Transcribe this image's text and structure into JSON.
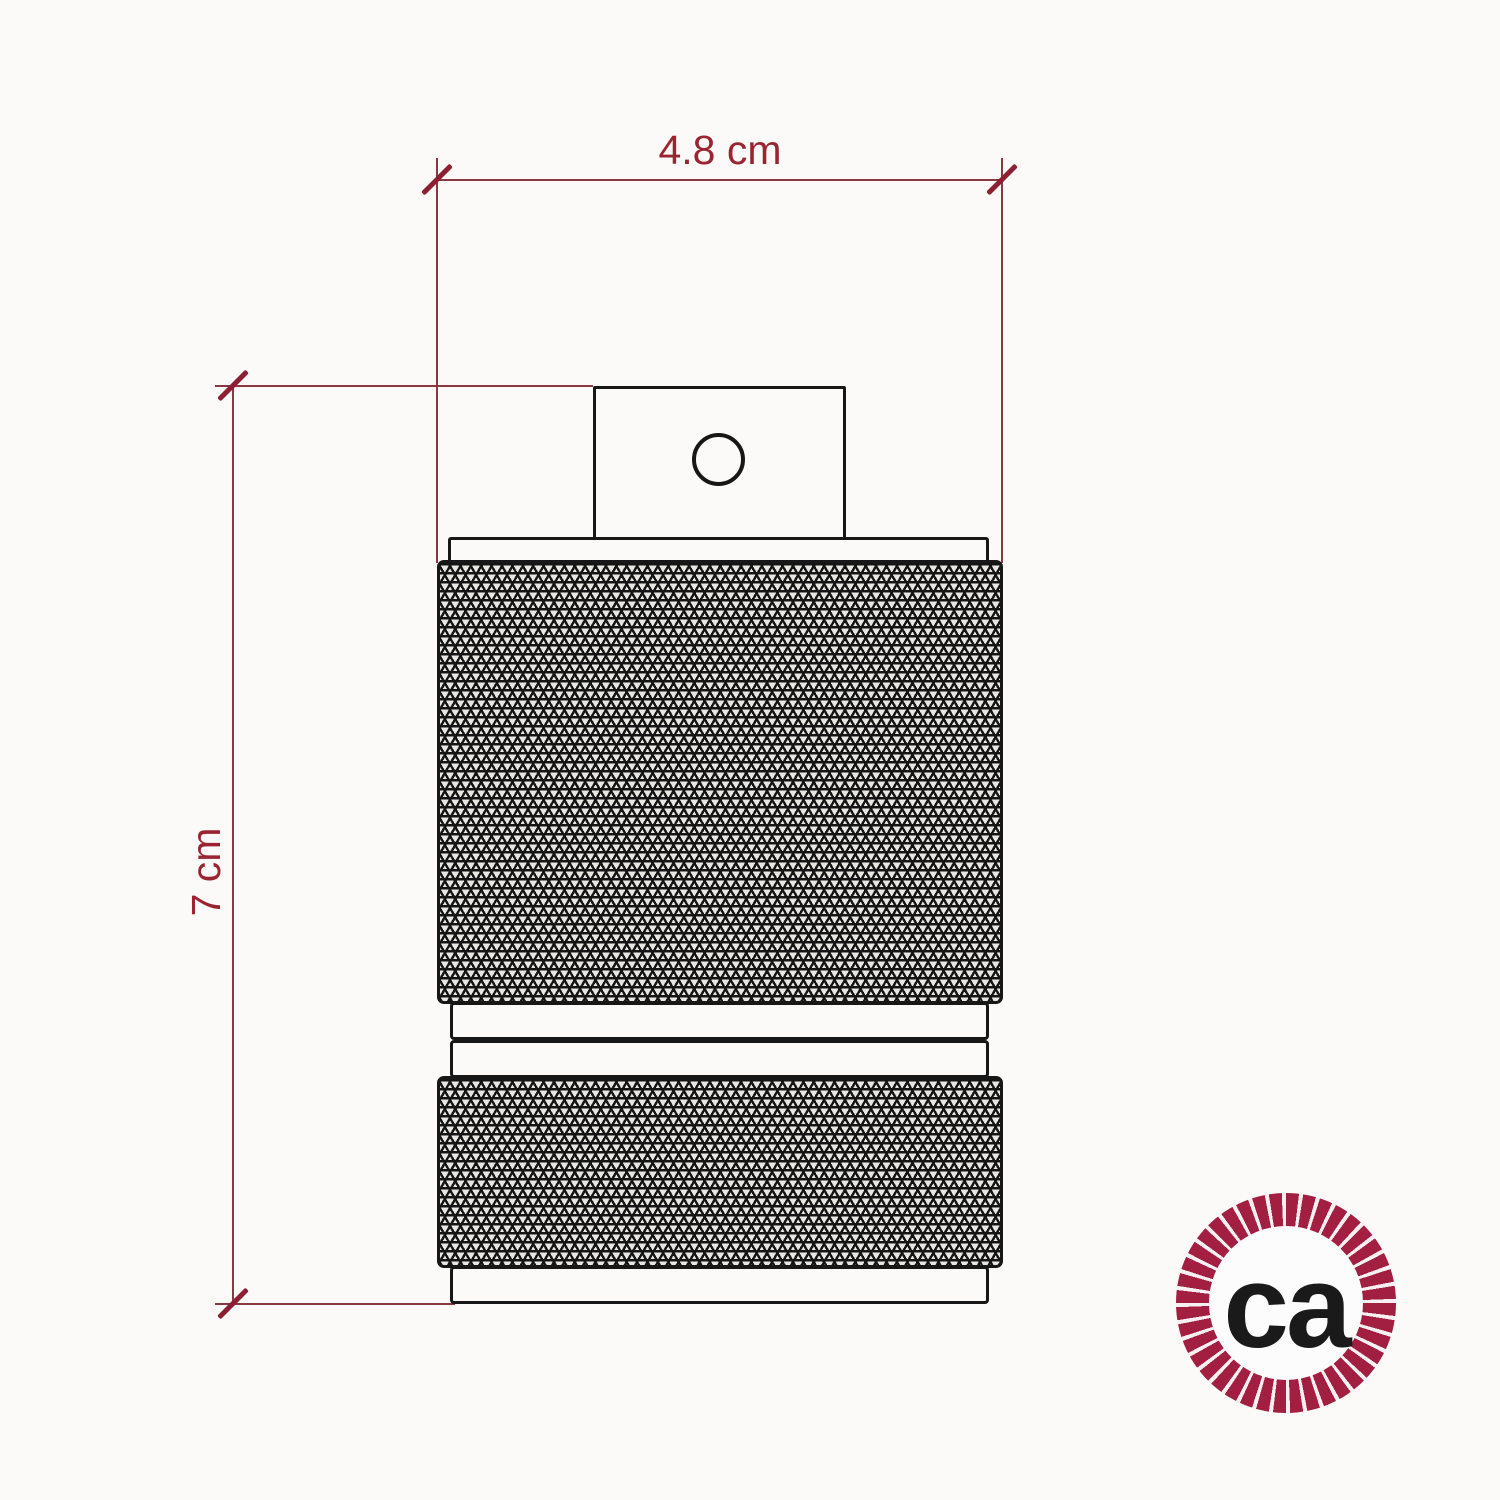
{
  "title": "Lamp holder technical dimension drawing",
  "dimensions": {
    "width": {
      "label": "4.8 cm"
    },
    "height": {
      "label": "7 cm"
    }
  },
  "logo": {
    "text": "ca"
  },
  "colors": {
    "background": "#fbfaf9",
    "drawing_stroke": "#171717",
    "knurl_background": "#e8e6e3",
    "dimension_line": "#8a3842",
    "dimension_tick": "#8e1e31",
    "dimension_text": "#9a2530",
    "rope": "#a31f42",
    "logo_text": "#1a1a1a"
  }
}
